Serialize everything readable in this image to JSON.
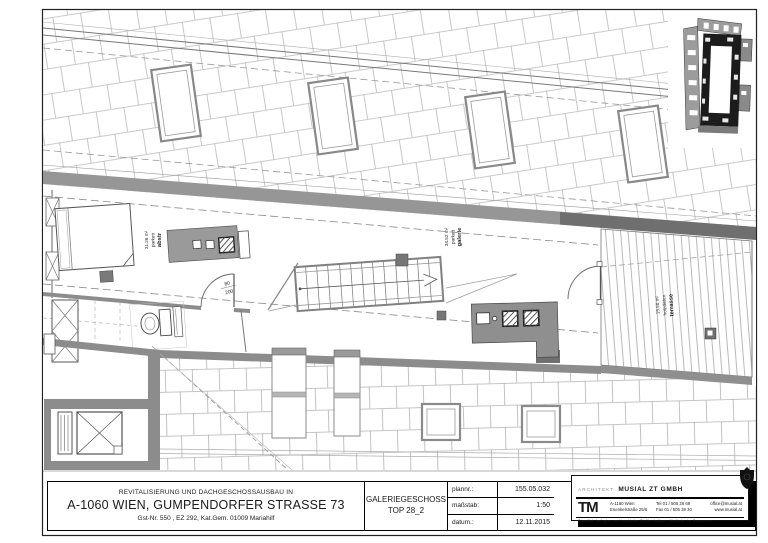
{
  "title_block": {
    "project": {
      "line1": "REVITALISIERUNG UND DACHGESCHOSSAUSBAU IN",
      "line2": "A-1060 WIEN, GUMPENDORFER STRASSE 73",
      "line3": "Gst-Nr. 550 , EZ 292, Kat.Gem. 01009 Mariahilf"
    },
    "drawing": {
      "line1": "GALERIEGESCHOSS",
      "line2": "TOP 28_2"
    },
    "meta": {
      "rows": [
        {
          "label": "plannr.:",
          "value": "155.05.032"
        },
        {
          "label": "maßstab:",
          "value": "1:50"
        },
        {
          "label": "datum.:",
          "value": "12.11.2015"
        }
      ]
    }
  },
  "architect": {
    "role": "ARCHITEKT",
    "firm": "MUSIAL ZT GMBH",
    "logo": "TM",
    "address_line1": "A-1160 Wien",
    "address_line2": "Enenkelstraße 25/5",
    "tel": "Tel 01 / 505 26 69",
    "fax": "Fax 01 / 505 39 30",
    "email": "office@musial.at",
    "web": "www.musial.at",
    "certification": "Staatlich befugter und beeideter Ziviltechniker - Mediator im Bauwesen"
  },
  "plan": {
    "rooms": [
      {
        "name": "abstr",
        "floor": "parkett",
        "area": "31.26 m²"
      },
      {
        "name": "galerie",
        "floor": "parkett",
        "area": "34.52 m²"
      },
      {
        "name": "terrasse",
        "floor": "holzdielen",
        "area": "15.50 m²"
      }
    ],
    "door_label": {
      "width": "80",
      "height": "200"
    }
  },
  "colors": {
    "paper": "#ffffff",
    "ink": "#1a1a1a",
    "wall_gray": "#8c8c8c",
    "wall_dark": "#6f6f6f",
    "tile_line": "#b8b8b8",
    "furniture_gray": "#9a9a9a"
  }
}
